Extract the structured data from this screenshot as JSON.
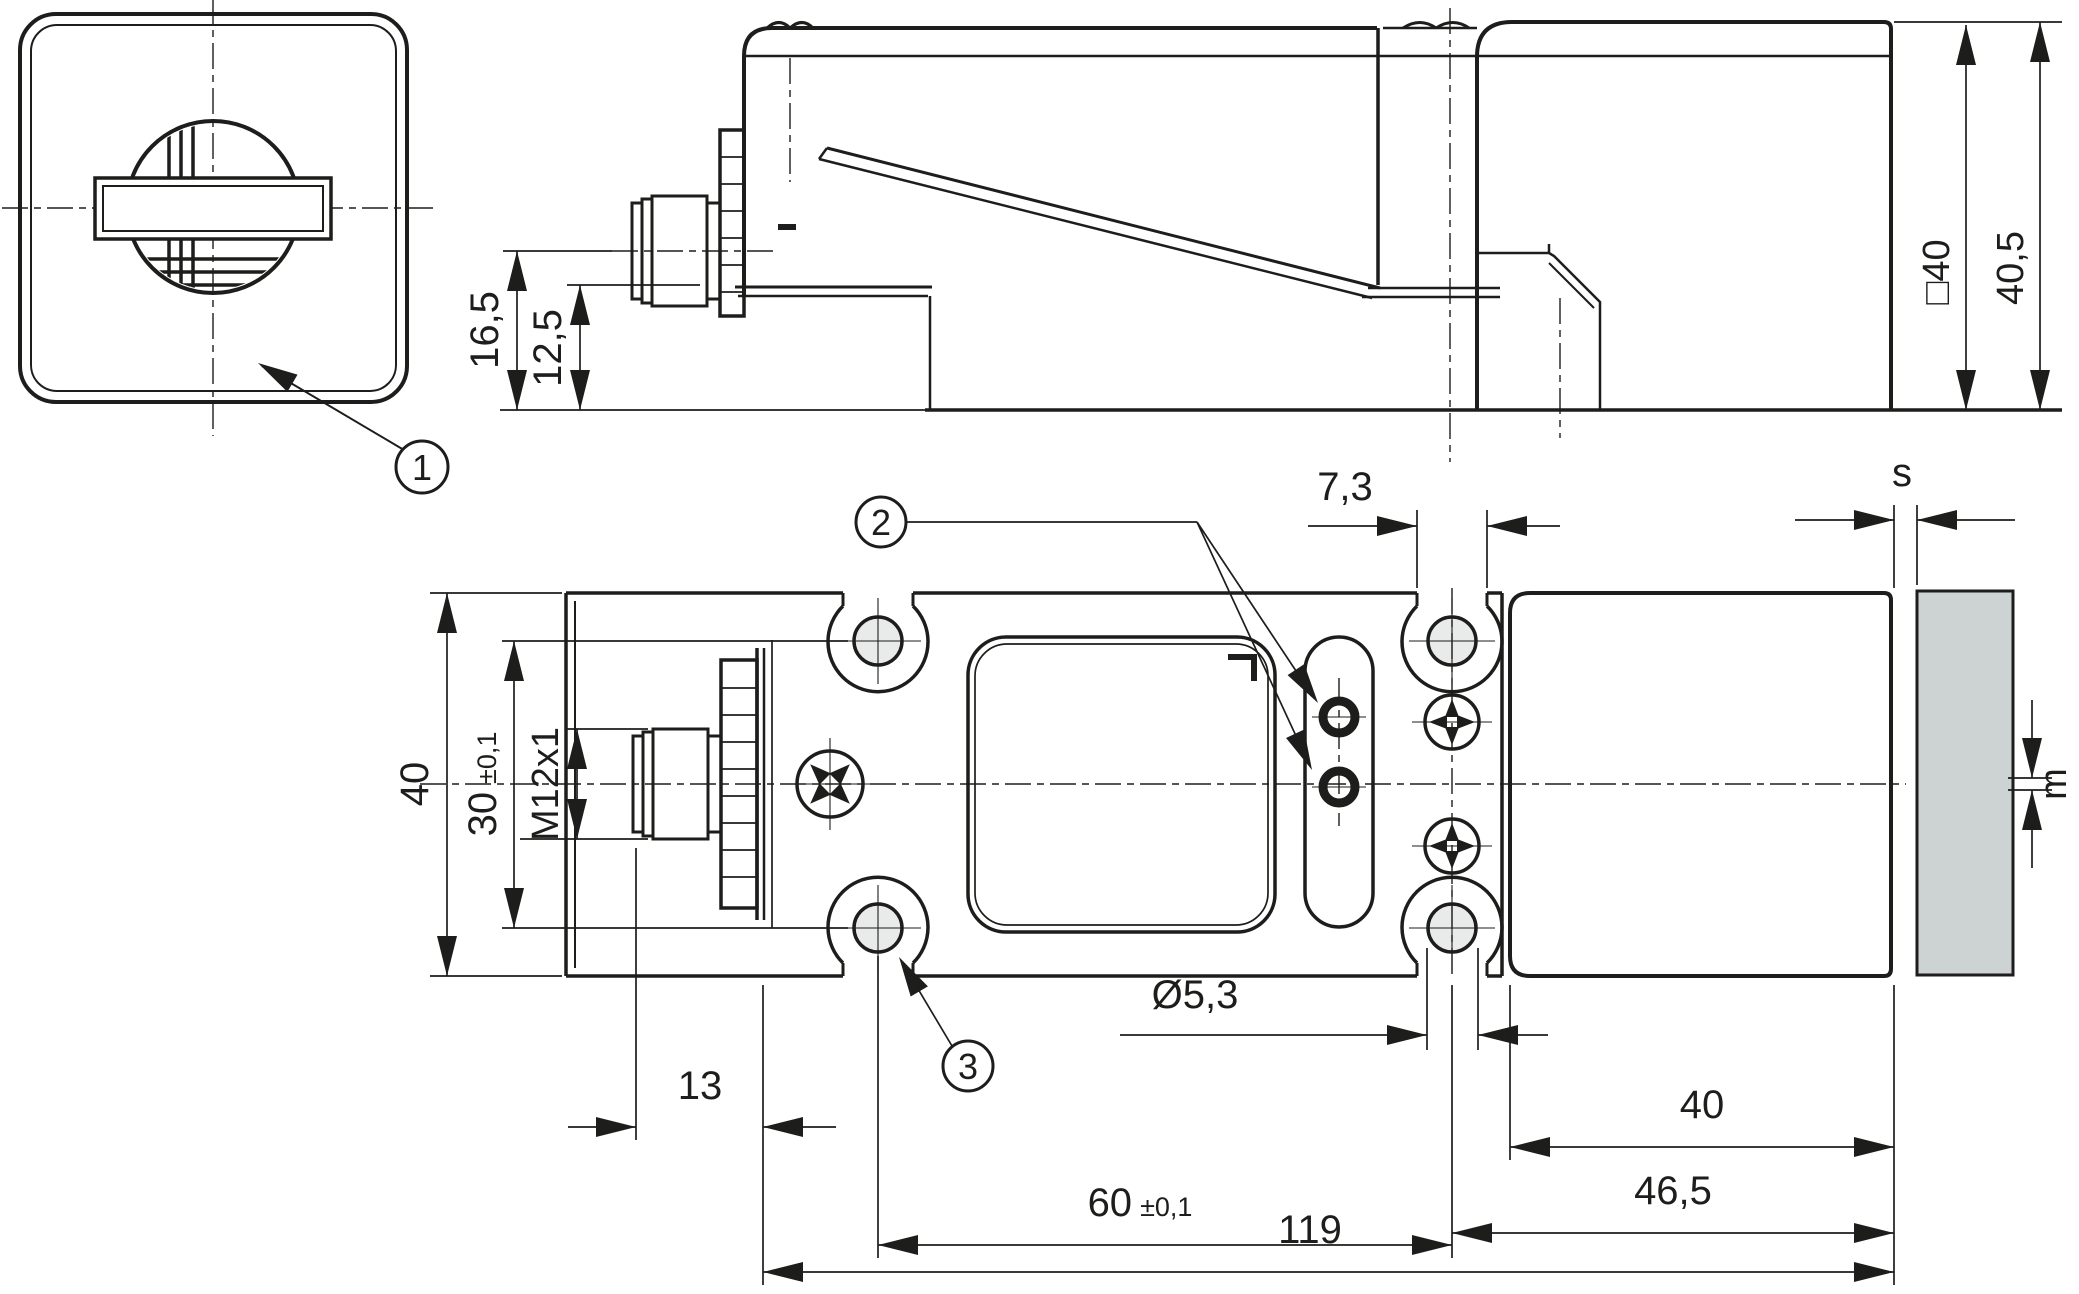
{
  "logo": {
    "text": "EUCHNER"
  },
  "balloons": {
    "item1": "1",
    "item2": "2",
    "item3": "3"
  },
  "dimensions": {
    "side_view": {
      "axis_height": "16,5",
      "connector_height": "12,5",
      "head_square": "□40",
      "head_height": "40,5"
    },
    "plan_view": {
      "body_width": "40",
      "hole_spacing_vertical": "30",
      "hole_spacing_vertical_tol": "±0,1",
      "connector_thread": "M12x1",
      "slot_width": "7,3",
      "gap": "s",
      "offset": "m",
      "hole_diameter": "Ø5,3",
      "connector_length": "13",
      "head_length": "40",
      "head_to_hole": "46,5",
      "hole_spacing_horizontal": "60",
      "hole_spacing_horizontal_tol": "±0,1",
      "total_length": "119"
    }
  },
  "colors": {
    "line": "#1d1d1b",
    "hole_fill": "#e9ebea",
    "actuator_fill": "#cdd2d2",
    "background": "#ffffff"
  }
}
